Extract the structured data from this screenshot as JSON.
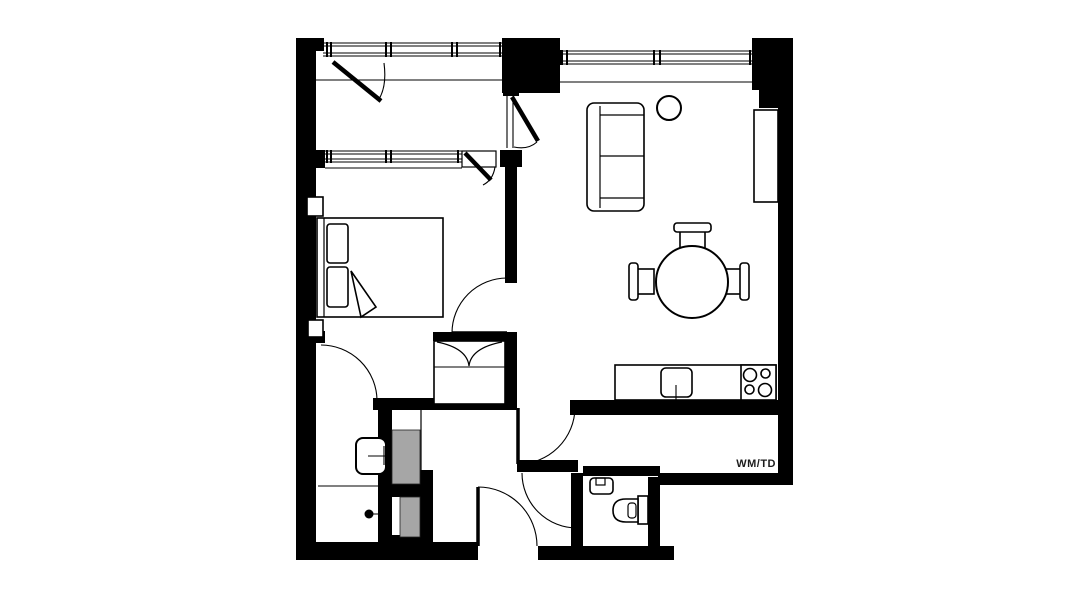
{
  "plan": {
    "utility_label": "WM/TD",
    "colors": {
      "wall": "#000000",
      "background": "#ffffff",
      "shaft": "#a6a6a6",
      "label": "#1d1d1d"
    },
    "rooms": [
      "balcony",
      "bedroom",
      "living-dining-room",
      "kitchen",
      "bathroom",
      "wc",
      "hallway",
      "utility-corridor"
    ],
    "fixtures": [
      "double-bed",
      "bedside-piers",
      "wardrobe",
      "sofa",
      "plant",
      "sideboard",
      "dining-table",
      "dining-chairs",
      "kitchen-counter",
      "kitchen-sink",
      "cooktop",
      "washbasin",
      "shower-head",
      "shower-screen",
      "toilet",
      "wc-sink",
      "service-shafts",
      "balcony-door",
      "living-room-windows",
      "bedroom-window",
      "entry-door"
    ]
  }
}
